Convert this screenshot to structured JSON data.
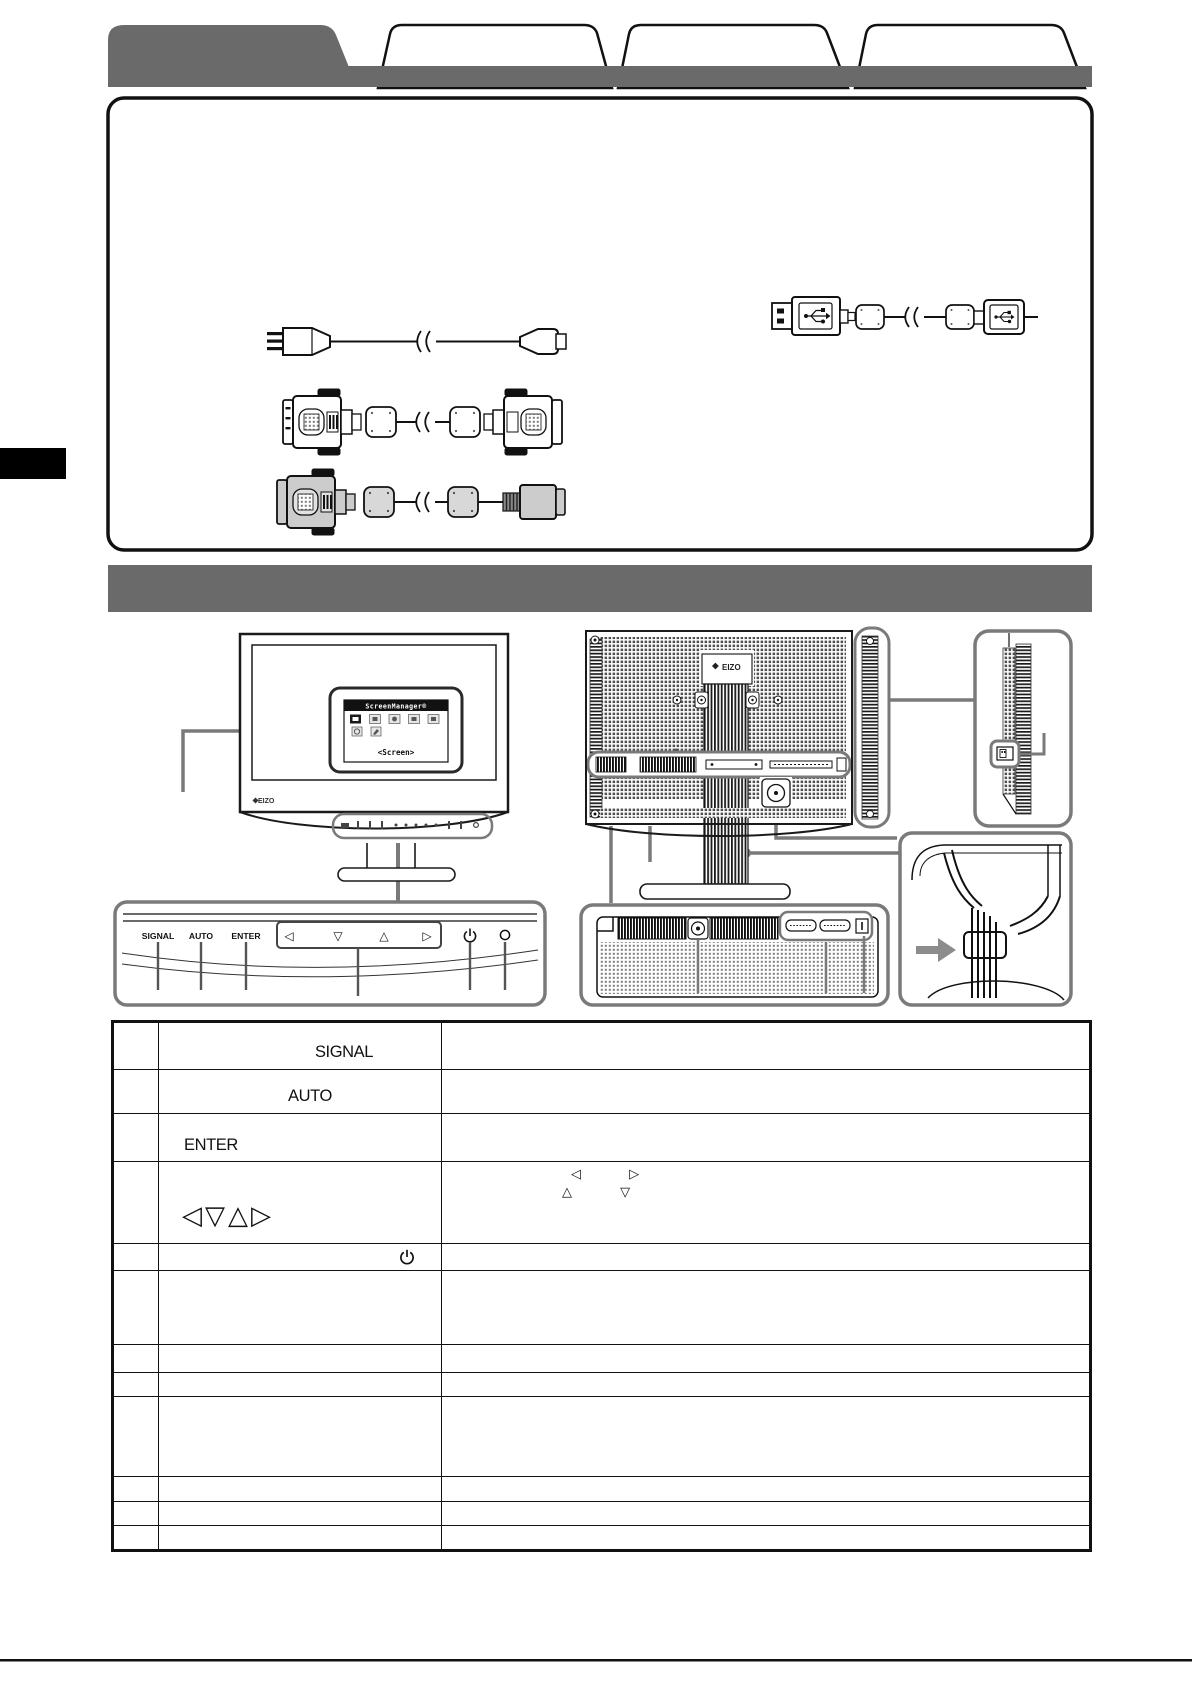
{
  "page": {
    "bg": "#ffffff",
    "accent_gray": "#6a6a6a",
    "callout_gray": "#7a7a7a",
    "line_black": "#111111"
  },
  "tabs": {
    "count": 4,
    "selected_index": 0,
    "items": [
      {
        "label": "",
        "selected": true
      },
      {
        "label": "",
        "selected": false
      },
      {
        "label": "",
        "selected": false
      },
      {
        "label": "",
        "selected": false
      }
    ]
  },
  "accessories": {
    "illustrations": [
      "power-cord",
      "dvi-cable-white",
      "dvi-cable-gray",
      "usb-cable"
    ]
  },
  "branding": {
    "front_logo": "EIZO",
    "rear_logo": "EIZO"
  },
  "osd": {
    "title": "ScreenManager®",
    "menu_label": "<Screen>"
  },
  "panel": {
    "signal": "SIGNAL",
    "auto": "AUTO",
    "enter": "ENTER",
    "arrows": [
      "◁",
      "▽",
      "△",
      "▷"
    ],
    "power_icon": "power-symbol",
    "indicator_icon": "power-indicator-lamp"
  },
  "diagrams": {
    "front_view": "monitor-front-view",
    "rear_view": "monitor-rear-view",
    "side_view": "monitor-side-view",
    "control_panel": "control-panel-closeup",
    "connector_panel": "rear-connector-closeup",
    "cable_holder": "cable-holder-closeup"
  },
  "table": {
    "rows": [
      {
        "label": "SIGNAL",
        "desc": ""
      },
      {
        "label": "AUTO",
        "desc": ""
      },
      {
        "label": "ENTER",
        "desc": ""
      },
      {
        "label": "◁▽△▷",
        "desc_line1": "◁ ▷",
        "desc_line2": "△ ▽"
      },
      {
        "label": "",
        "icon": "power-icon",
        "desc": ""
      },
      {
        "label": "",
        "desc": ""
      },
      {
        "label": "",
        "desc": ""
      },
      {
        "label": "",
        "desc": ""
      },
      {
        "label": "",
        "desc": ""
      },
      {
        "label": "",
        "desc": ""
      },
      {
        "label": "",
        "desc": ""
      },
      {
        "label": "",
        "desc": ""
      }
    ]
  }
}
